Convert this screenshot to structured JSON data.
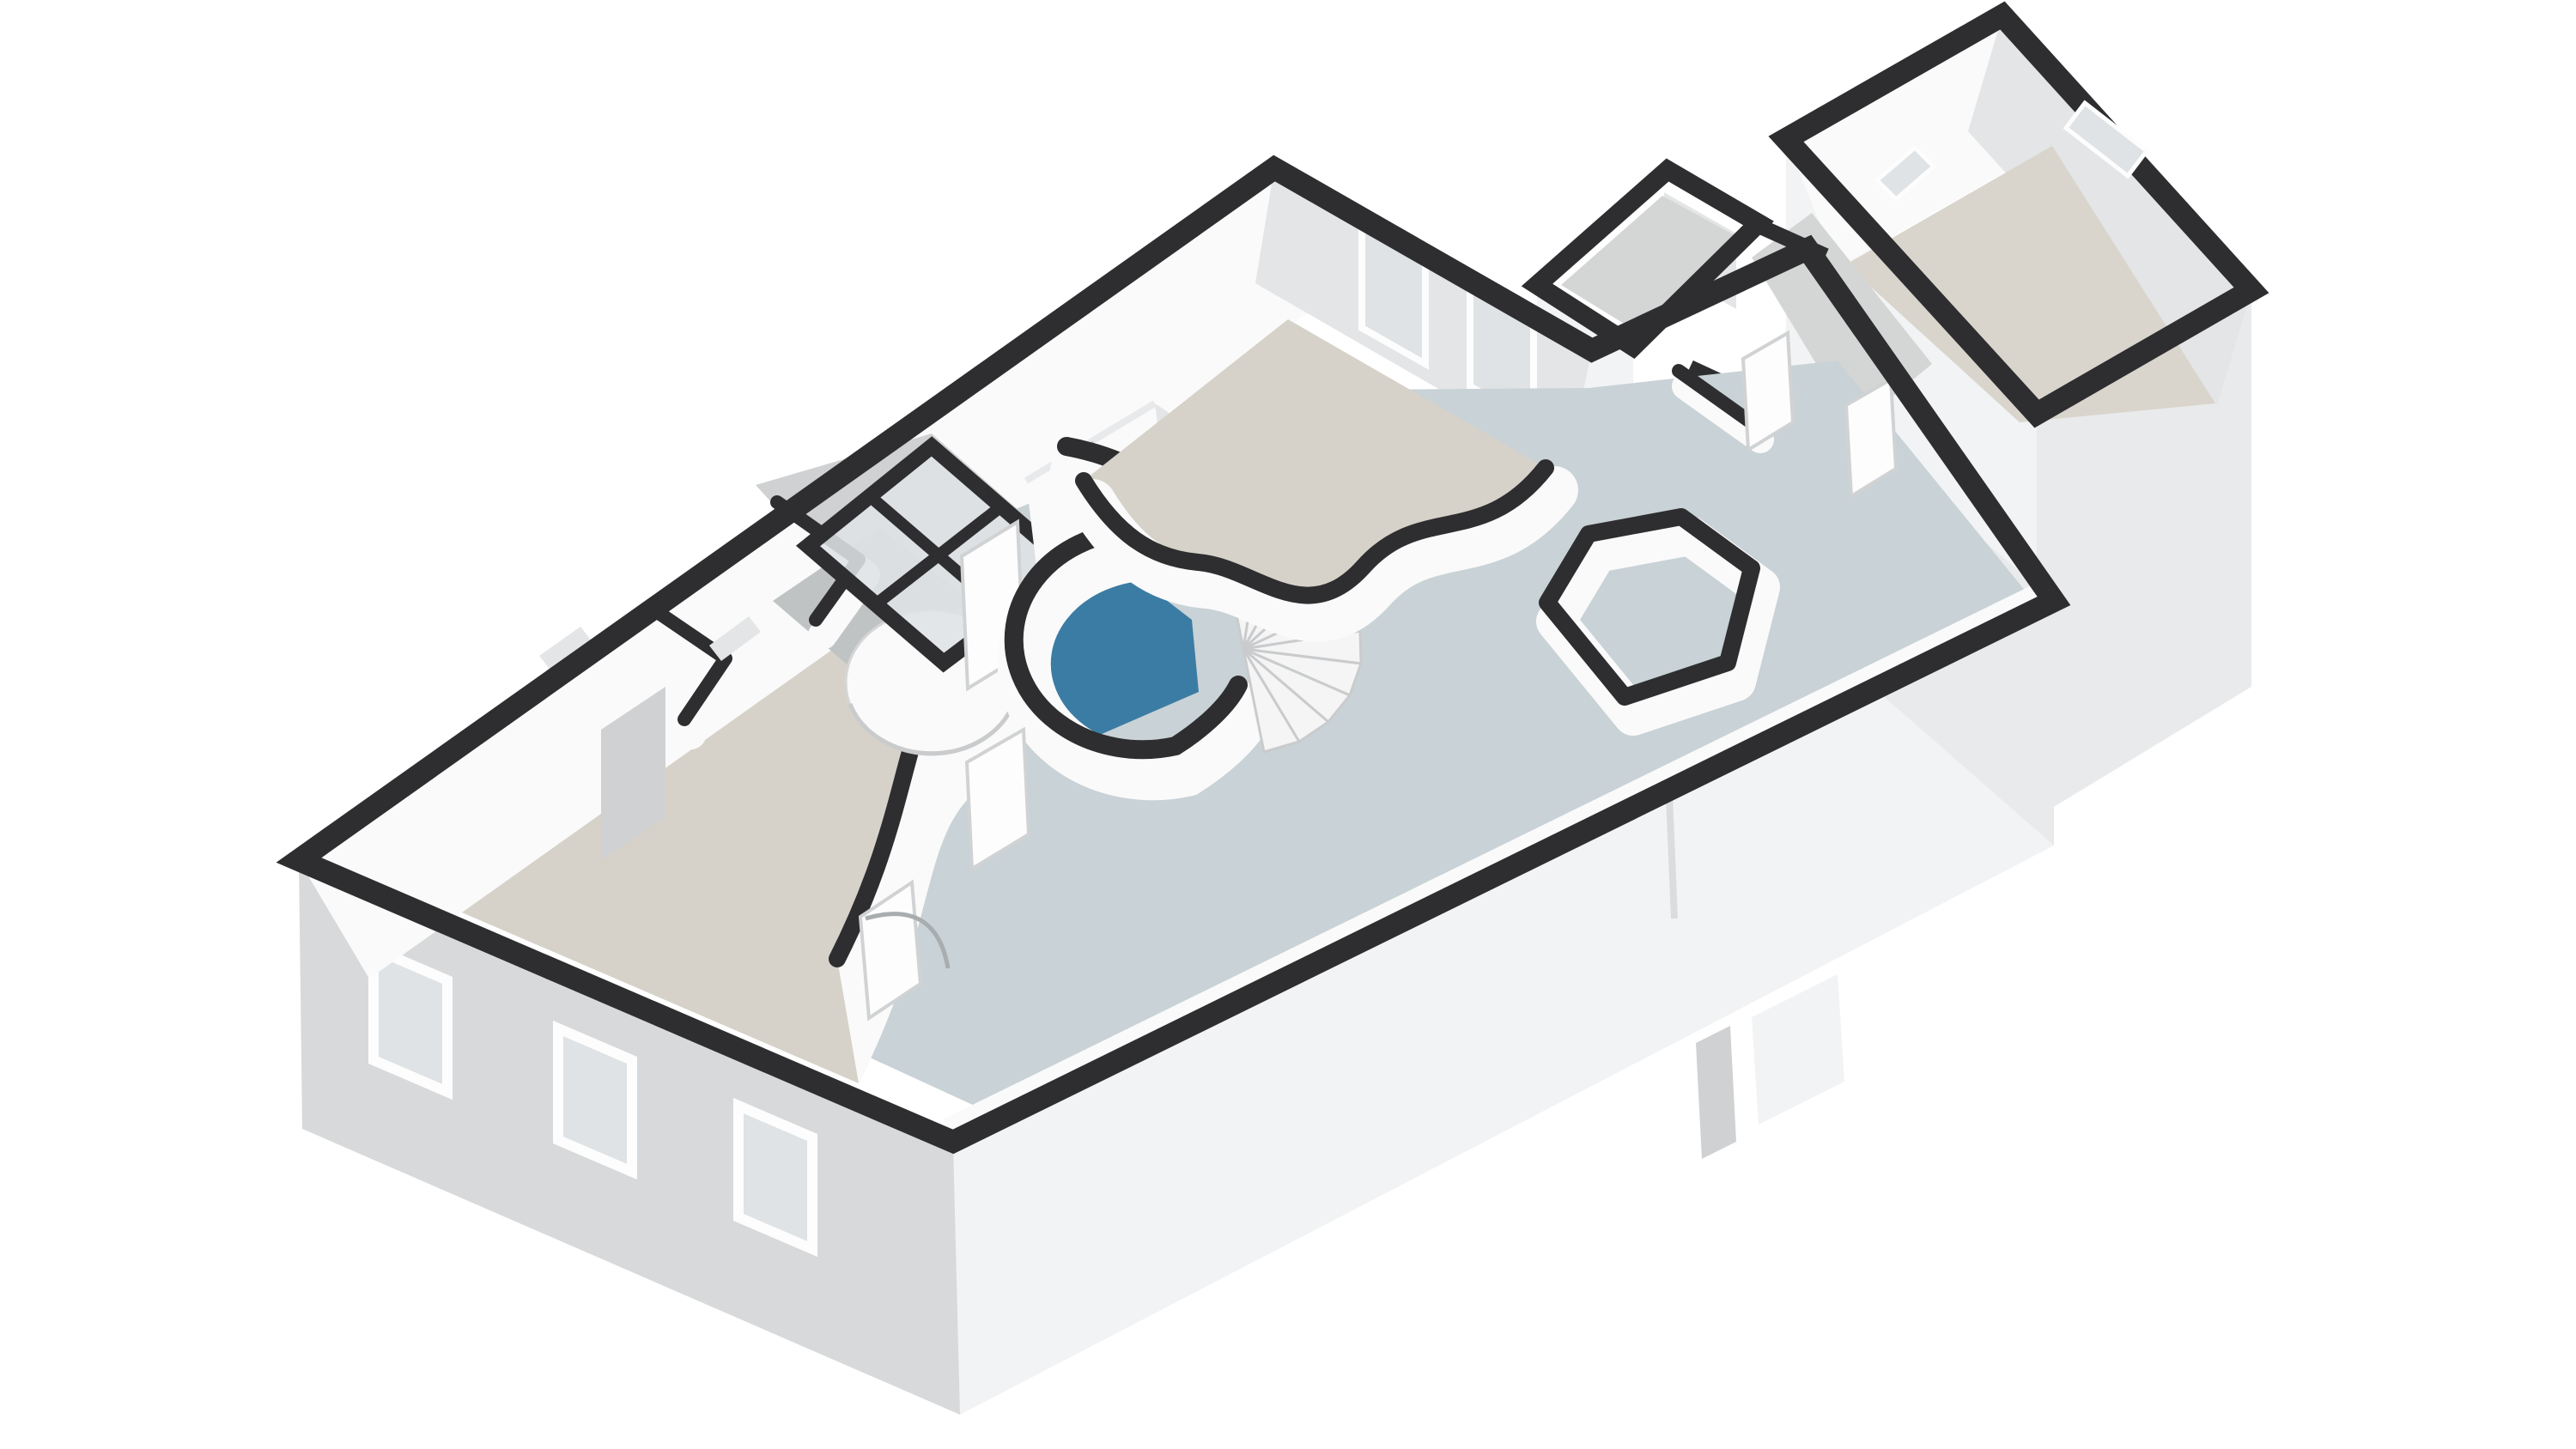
{
  "scene": {
    "type": "3d-floorplan-render",
    "view": "isometric-top-down",
    "background": "#ffffff",
    "floors_shown": 1
  },
  "palette": {
    "wall_top": "#2e2e30",
    "wall_top_soft": "#3a3a3c",
    "wall_face": "#fafafa",
    "wall_face_shade": "#e4e5e6",
    "wall_face_dark": "#cfd1d2",
    "wall_face_deep": "#c0c4c5",
    "exterior_side": "#d8d9da",
    "exterior_side_light": "#f2f3f4",
    "exterior_end": "#e9eaeb",
    "floor_beige": "#d6d2c9",
    "floor_beige_right": "#d9d5cd",
    "floor_hall": "#c9d2d6",
    "floor_bath_blue": "#3b7ca4",
    "floor_gray": "#bfc3c4",
    "floor_connector": "#d4d6d6",
    "glass": "#dfe3e5",
    "glass_frame": "#f6f8f8",
    "window_frame": "#fdfdfd",
    "stair_tread": "#f5f5f6",
    "stair_edge": "#c9cbcc",
    "door_leaf": "#fdfdfd",
    "door_edge": "#d0d2d3",
    "arc_line": "#a8adaf",
    "seam": "#dadcdd",
    "cylinder_edge": "#d4d6d7",
    "handle": "#9aa0a2",
    "cabinet_top": "#e8e9ea"
  },
  "rooms": [
    {
      "id": "bedroom-left",
      "floor_finish": "beige"
    },
    {
      "id": "hallway",
      "floor_finish": "blue-gray"
    },
    {
      "id": "shower-room",
      "floor_finish": "gray",
      "fixtures": [
        "round-shower"
      ]
    },
    {
      "id": "bathroom",
      "floor_finish": "teal-blue",
      "fixtures": [
        "skylight"
      ]
    },
    {
      "id": "bedroom-top",
      "floor_finish": "beige",
      "windows": 2
    },
    {
      "id": "toilet-nook",
      "floor_finish": "blue-gray"
    },
    {
      "id": "east-corridor",
      "floor_finish": "blue-gray",
      "doors": 2
    },
    {
      "id": "entry-porch",
      "floor_finish": "gray"
    },
    {
      "id": "right-block-room",
      "floor_finish": "beige",
      "windows": 2
    }
  ],
  "features": {
    "spiral_staircase_treads": 10,
    "skylight_panes": 4,
    "exterior_windows_sw_facade": 3,
    "wardrobe_doors": 2,
    "curved_organic_walls": 3
  }
}
